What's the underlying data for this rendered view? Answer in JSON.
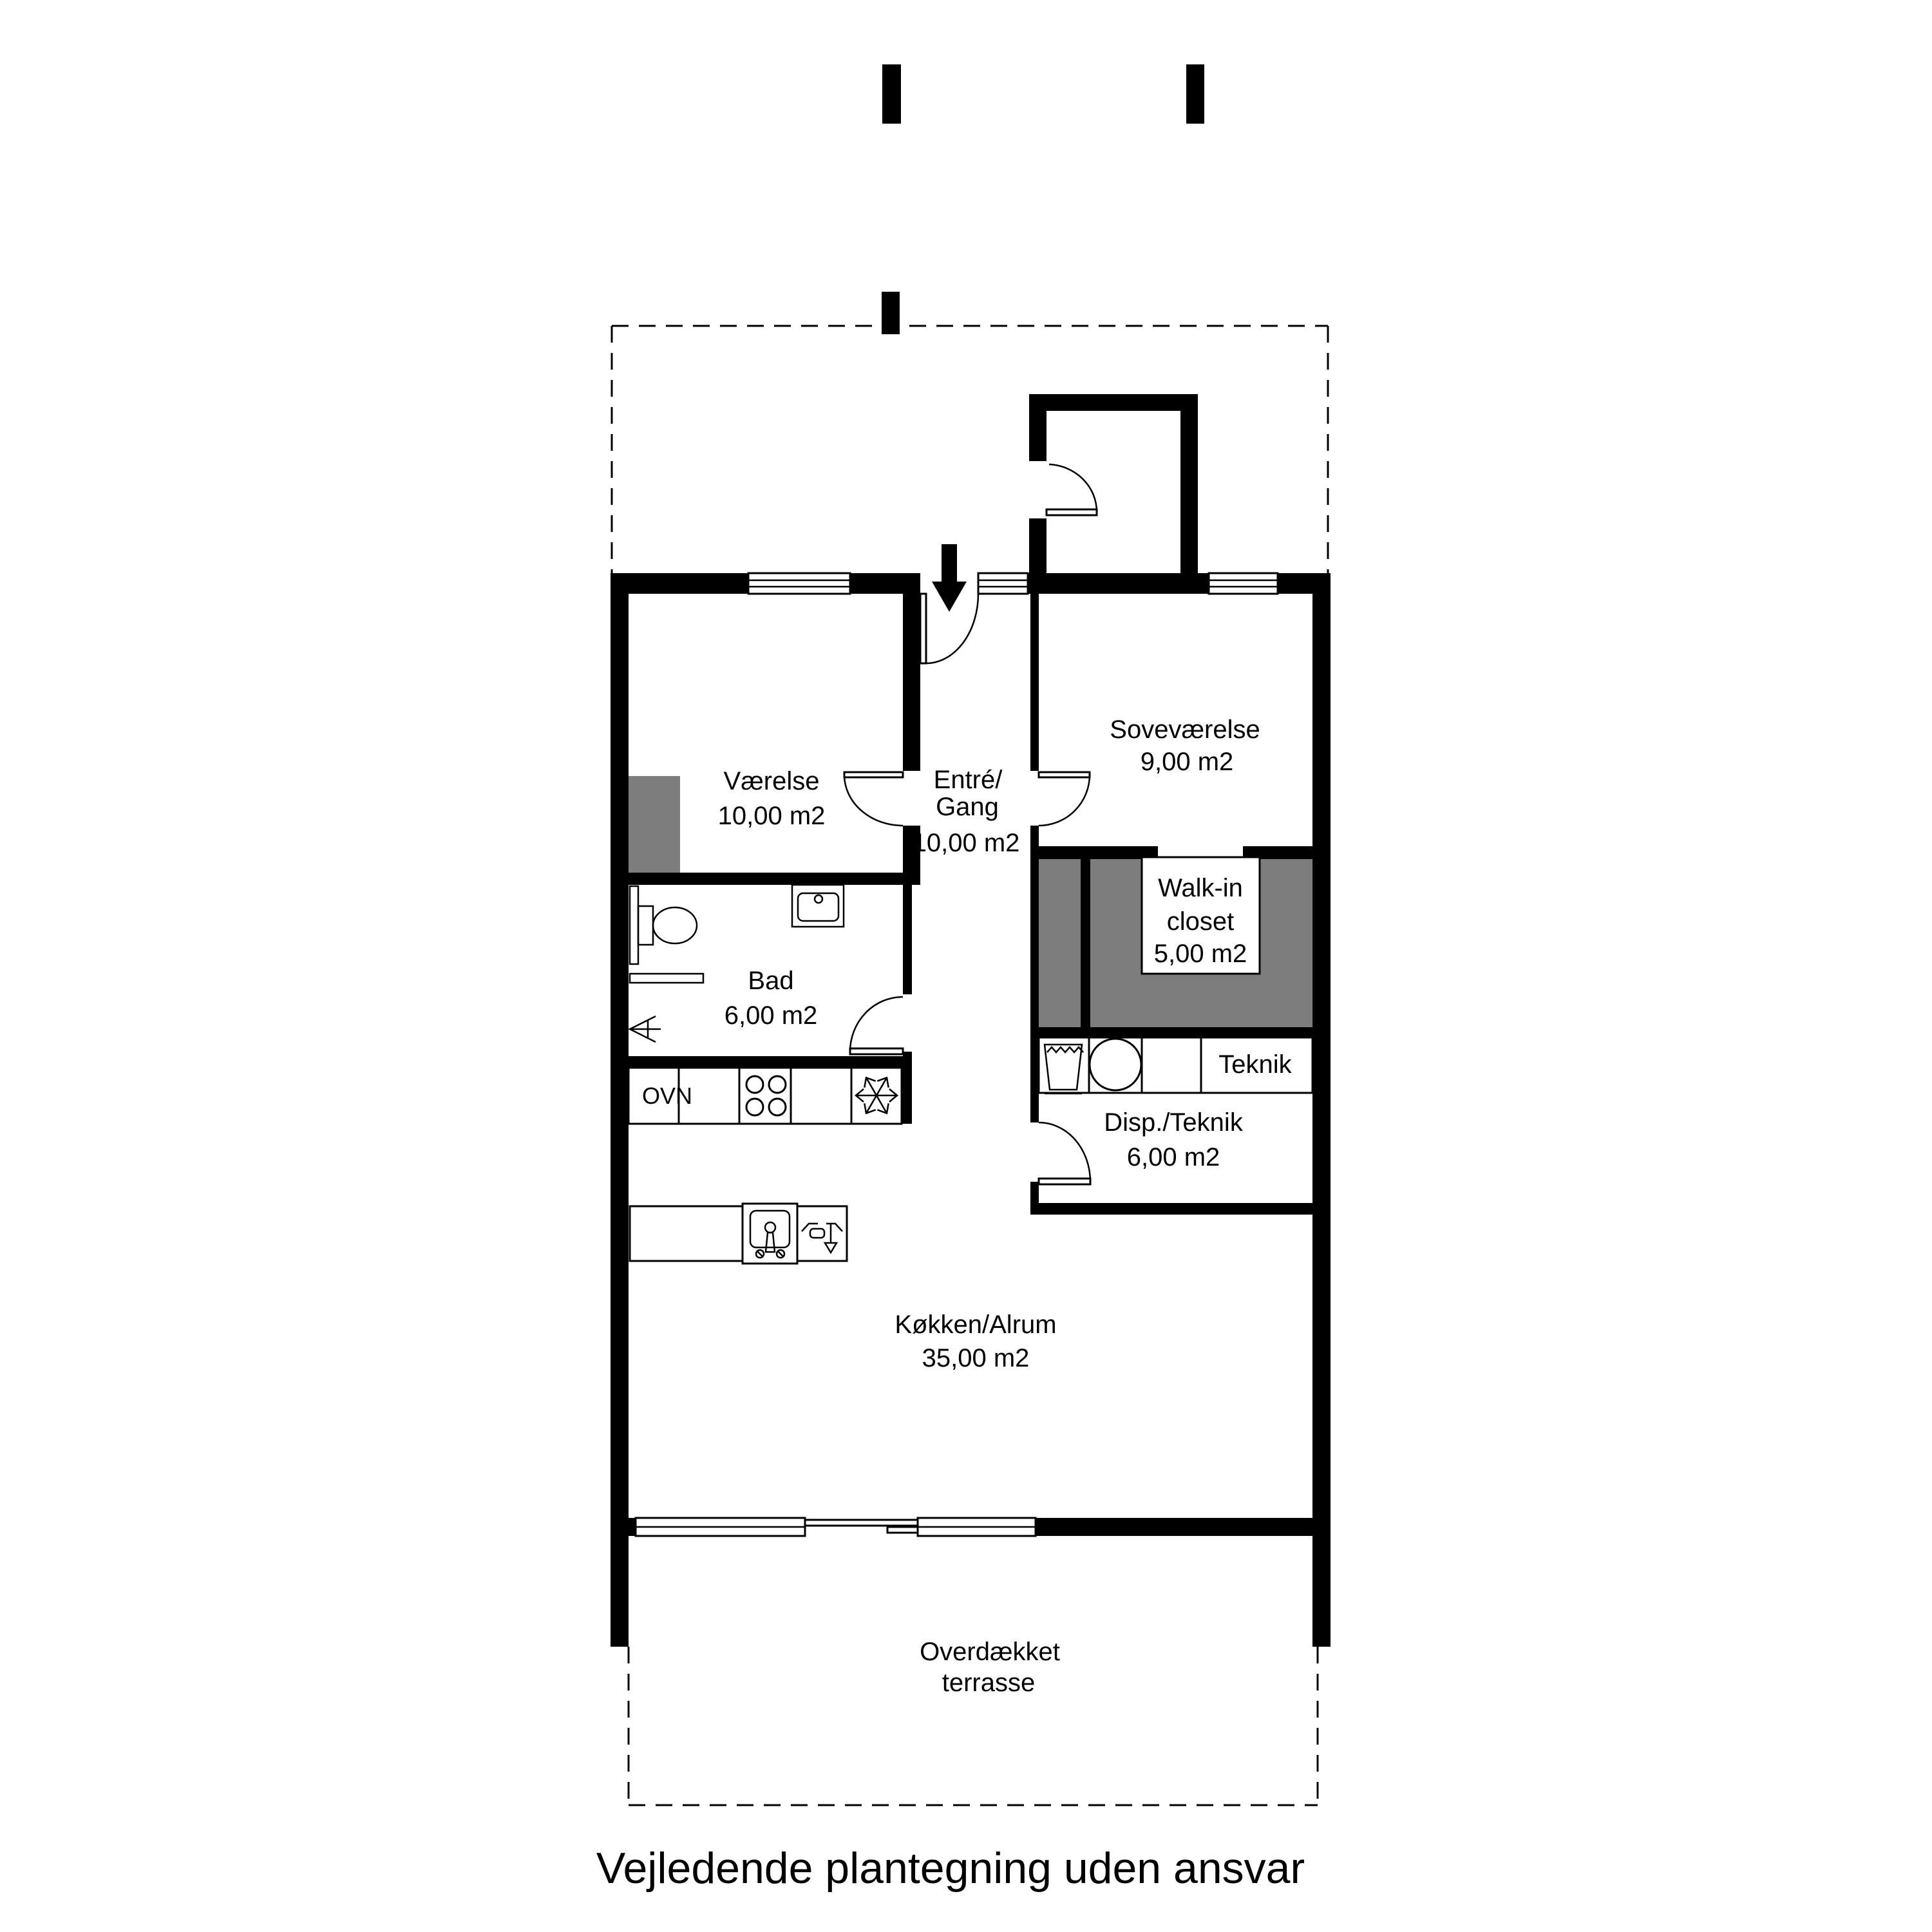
{
  "plan": {
    "rooms": {
      "vaerelse": {
        "name": "Værelse",
        "area": "10,00 m2"
      },
      "entre": {
        "line1": "Entré/",
        "line2": "Gang",
        "area": "10,00 m2"
      },
      "sovevaerelse": {
        "name": "Soveværelse",
        "area": "9,00 m2"
      },
      "walkin": {
        "line1": "Walk-in",
        "line2": "closet",
        "area": "5,00 m2"
      },
      "bad": {
        "name": "Bad",
        "area": "6,00 m2"
      },
      "teknik": {
        "name": "Teknik"
      },
      "disp": {
        "name": "Disp./Teknik",
        "area": "6,00 m2"
      },
      "kokken": {
        "name": "Køkken/Alrum",
        "area": "35,00 m2"
      },
      "terrasse": {
        "line1": "Overdækket",
        "line2": "terrasse"
      }
    },
    "appliances": {
      "oven": "OVN"
    },
    "footer": "Vejledende plantegning uden ansvar",
    "colors": {
      "wall": "#000000",
      "wardrobe": "#7d7d7d",
      "paper": "#ffffff"
    }
  }
}
